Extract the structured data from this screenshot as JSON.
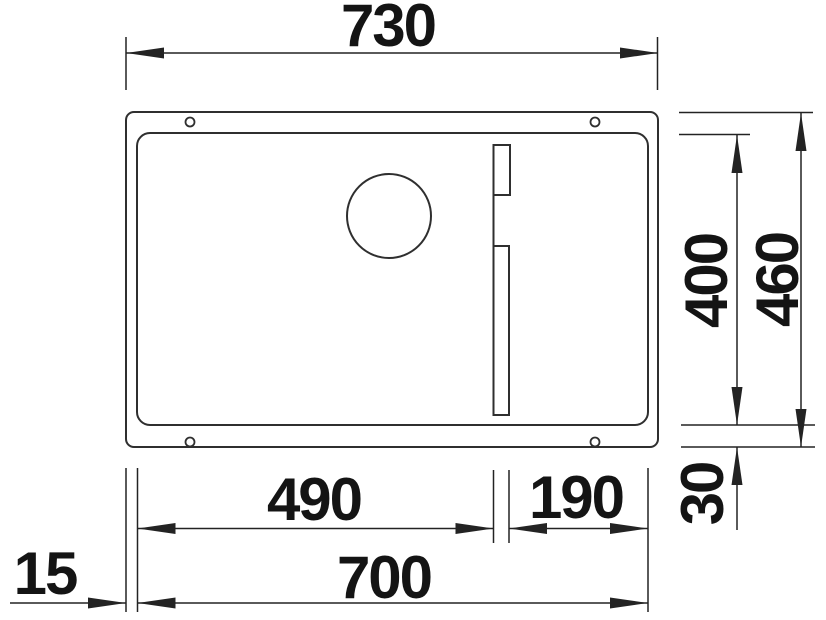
{
  "drawing": {
    "subject": "undermount-sink-top-view-installation-drawing",
    "view": "top",
    "background_color": "#ffffff",
    "line_color": "#2f2f2f",
    "dim_line_color": "#232323",
    "text_color": "#141414",
    "units": "mm",
    "dimensions": {
      "top_width": "730",
      "bowl_depth": "400",
      "overall_depth": "460",
      "bottom_rim": "30",
      "left_bowl_width": "490",
      "right_section_width": "190",
      "bowl_width": "700",
      "side_rim": "15"
    }
  }
}
